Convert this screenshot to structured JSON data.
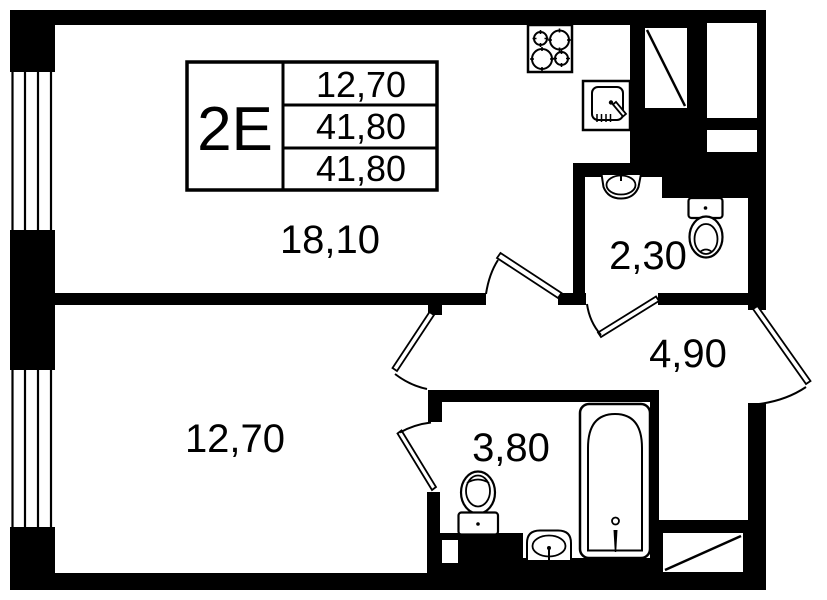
{
  "title_block": {
    "unit": "2E",
    "rows": [
      "12,70",
      "41,80",
      "41,80"
    ]
  },
  "rooms": [
    {
      "id": "living-kitchen",
      "area": "18,10"
    },
    {
      "id": "wc",
      "area": "2,30"
    },
    {
      "id": "hallway",
      "area": "4,90"
    },
    {
      "id": "bedroom",
      "area": "12,70"
    },
    {
      "id": "bathroom",
      "area": "3,80"
    }
  ],
  "icons": [
    "stove-icon",
    "kitchen-sink-icon",
    "wc-basin-icon",
    "wc-toilet-icon",
    "bath-toilet-icon",
    "bath-basin-icon",
    "bathtub-icon",
    "vent-shaft-icon",
    "window-icon",
    "door-icon"
  ],
  "colors": {
    "wall": "#000000",
    "floor": "#ffffff"
  }
}
